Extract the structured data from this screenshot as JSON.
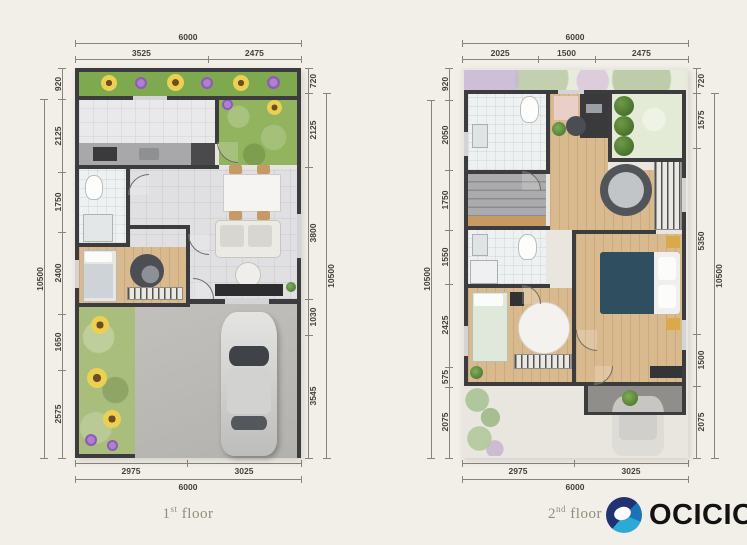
{
  "colors": {
    "background": "#f2efe8",
    "wall": "#3c3c3f",
    "dim_line": "#8a8478",
    "dim_text": "#45403a",
    "label": "#938b7c",
    "logo_navy": "#203271",
    "logo_blue": "#2ea9d6",
    "logo_text": "#121212"
  },
  "floors": [
    {
      "label_num": "1",
      "label_sup": "st",
      "label_word": "floor",
      "dims": {
        "top": {
          "total": "6000",
          "segments": [
            "3525",
            "2475"
          ]
        },
        "left": {
          "total": "10500",
          "segments": [
            "920",
            "2125",
            "1750",
            "2400",
            "1650",
            "2575"
          ]
        },
        "right": {
          "total": "10500",
          "segments": [
            "720",
            "2125",
            "3800",
            "1030",
            "3545"
          ]
        },
        "bottom": {
          "total": "6000",
          "segments": [
            "2975",
            "3025"
          ]
        }
      }
    },
    {
      "label_num": "2",
      "label_sup": "nd",
      "label_word": "floor",
      "dims": {
        "top": {
          "total": "6000",
          "segments": [
            "2025",
            "1500",
            "2475"
          ]
        },
        "left": {
          "total": "10500",
          "segments": [
            "920",
            "2050",
            "1750",
            "1550",
            "2425",
            "575",
            "2075"
          ]
        },
        "right": {
          "total": "10500",
          "segments": [
            "720",
            "1575",
            "5350",
            "1500",
            "2075"
          ]
        },
        "bottom": {
          "total": "6000",
          "segments": [
            "2975",
            "3025"
          ]
        }
      }
    }
  ],
  "logo": {
    "text": "OCICIO",
    "icon": "ocicio-ring-icon"
  }
}
